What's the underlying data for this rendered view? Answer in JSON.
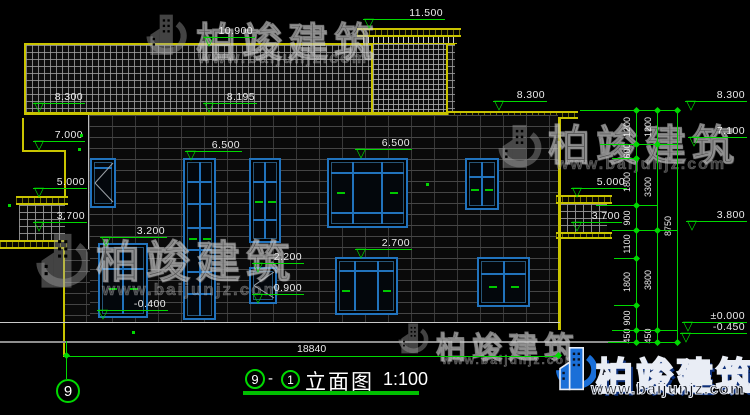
{
  "drawing": {
    "title": {
      "grid_left": "9",
      "separator": "-",
      "grid_right": "1",
      "name": "立面图",
      "scale": "1:100"
    },
    "grid_bubble_bottom": "9",
    "overall_width_dim": "18840"
  },
  "watermark": {
    "brand": "柏竣建筑",
    "site": "www.baijunjz.com"
  },
  "colors": {
    "dimension_green": "#00d800",
    "cad_yellow": "#c9c400",
    "window_blue": "#2173bd",
    "logo_blue": "#1a6fd8"
  },
  "elevation_markers": [
    {
      "label": "11.500",
      "x": 363,
      "y": 19,
      "w": 82
    },
    {
      "label": "10.900",
      "x": 203,
      "y": 37,
      "w": 52
    },
    {
      "label": "8.300",
      "x": 33,
      "y": 103,
      "w": 52
    },
    {
      "label": "8.195",
      "x": 203,
      "y": 103,
      "w": 54
    },
    {
      "label": "8.300",
      "x": 493,
      "y": 101,
      "w": 54
    },
    {
      "label": "8.300",
      "x": 685,
      "y": 101,
      "w": 62
    },
    {
      "label": "7.000",
      "x": 33,
      "y": 141,
      "w": 52
    },
    {
      "label": "7.100",
      "x": 688,
      "y": 137,
      "w": 59
    },
    {
      "label": "6.500",
      "x": 185,
      "y": 151,
      "w": 57
    },
    {
      "label": "6.500",
      "x": 355,
      "y": 149,
      "w": 57
    },
    {
      "label": "5.000",
      "x": 33,
      "y": 188,
      "w": 54
    },
    {
      "label": "5.000",
      "x": 571,
      "y": 188,
      "w": 56
    },
    {
      "label": "3.700",
      "x": 33,
      "y": 222,
      "w": 54
    },
    {
      "label": "3.700",
      "x": 571,
      "y": 222,
      "w": 51
    },
    {
      "label": "3.800",
      "x": 686,
      "y": 221,
      "w": 61
    },
    {
      "label": "3.200",
      "x": 100,
      "y": 237,
      "w": 67
    },
    {
      "label": "2.700",
      "x": 355,
      "y": 249,
      "w": 57
    },
    {
      "label": "2.200",
      "x": 252,
      "y": 263,
      "w": 52
    },
    {
      "label": "0.900",
      "x": 252,
      "y": 294,
      "w": 52
    },
    {
      "label": "-0.400",
      "x": 97,
      "y": 310,
      "w": 71
    },
    {
      "label": "±0.000",
      "x": 682,
      "y": 322,
      "w": 65
    },
    {
      "label": "-0.450",
      "x": 680,
      "y": 333,
      "w": 67
    }
  ],
  "dim_chains": {
    "chains": [
      {
        "x": 636,
        "bounds": [
          110,
          144,
          158,
          205,
          230,
          258,
          305,
          330,
          342
        ],
        "labels": [
          "1200",
          "600",
          "1800",
          "900",
          "1100",
          "1800",
          "900",
          "450"
        ]
      },
      {
        "x": 657,
        "bounds": [
          110,
          144,
          230,
          330,
          342
        ],
        "labels": [
          "1200",
          "3300",
          "3800",
          "450"
        ]
      },
      {
        "x": 677,
        "bounds": [
          110,
          342
        ],
        "labels": [
          "8750"
        ]
      }
    ],
    "connectors": [
      [
        580,
        678,
        110
      ],
      [
        600,
        678,
        144
      ],
      [
        612,
        637,
        158
      ],
      [
        596,
        658,
        205
      ],
      [
        612,
        678,
        230
      ],
      [
        614,
        638,
        258
      ],
      [
        614,
        638,
        305
      ],
      [
        612,
        678,
        330
      ],
      [
        608,
        678,
        342
      ]
    ]
  },
  "windows": [
    {
      "x": 90,
      "y": 158,
      "w": 26,
      "h": 50,
      "v": [],
      "hl": [
        0.18
      ],
      "diag": true
    },
    {
      "x": 183,
      "y": 158,
      "w": 33,
      "h": 162,
      "v": [
        0.5
      ],
      "hl": [
        0.14,
        0.28,
        0.43,
        0.57,
        0.71,
        0.85
      ],
      "dash": [
        [
          0.27,
          0.5
        ],
        [
          0.75,
          0.5
        ]
      ]
    },
    {
      "x": 249,
      "y": 158,
      "w": 32,
      "h": 85,
      "v": [
        0.5
      ],
      "hl": [
        0.27,
        0.74
      ],
      "dash": [
        [
          0.28,
          0.52
        ],
        [
          0.74,
          0.52
        ]
      ]
    },
    {
      "x": 327,
      "y": 158,
      "w": 81,
      "h": 70,
      "v": [
        0.31,
        0.69
      ],
      "hl": [
        0.2,
        0.8
      ],
      "dash": [
        [
          0.16,
          0.5
        ],
        [
          0.84,
          0.5
        ]
      ]
    },
    {
      "x": 465,
      "y": 158,
      "w": 34,
      "h": 52,
      "v": [
        0.5
      ],
      "hl": [
        0.36
      ],
      "dash": [
        [
          0.28,
          0.62
        ],
        [
          0.74,
          0.62
        ]
      ]
    },
    {
      "x": 98,
      "y": 243,
      "w": 50,
      "h": 75,
      "v": [
        0.5
      ],
      "hl": [
        0.34
      ],
      "dash": [
        [
          0.28,
          0.62
        ],
        [
          0.74,
          0.62
        ]
      ]
    },
    {
      "x": 249,
      "y": 267,
      "w": 28,
      "h": 37,
      "v": [],
      "hl": [],
      "diag": true
    },
    {
      "x": 335,
      "y": 257,
      "w": 63,
      "h": 58,
      "v": [
        0.3,
        0.7
      ],
      "hl": [
        0.22
      ],
      "dash": [
        [
          0.15,
          0.6
        ],
        [
          0.85,
          0.6
        ]
      ]
    },
    {
      "x": 477,
      "y": 257,
      "w": 53,
      "h": 50,
      "v": [
        0.5
      ],
      "hl": [
        0.32
      ],
      "dash": [
        [
          0.28,
          0.6
        ],
        [
          0.74,
          0.6
        ]
      ]
    }
  ],
  "dots": [
    [
      80,
      134
    ],
    [
      78,
      148
    ],
    [
      8,
      204
    ],
    [
      426,
      183
    ],
    [
      132,
      331
    ]
  ]
}
